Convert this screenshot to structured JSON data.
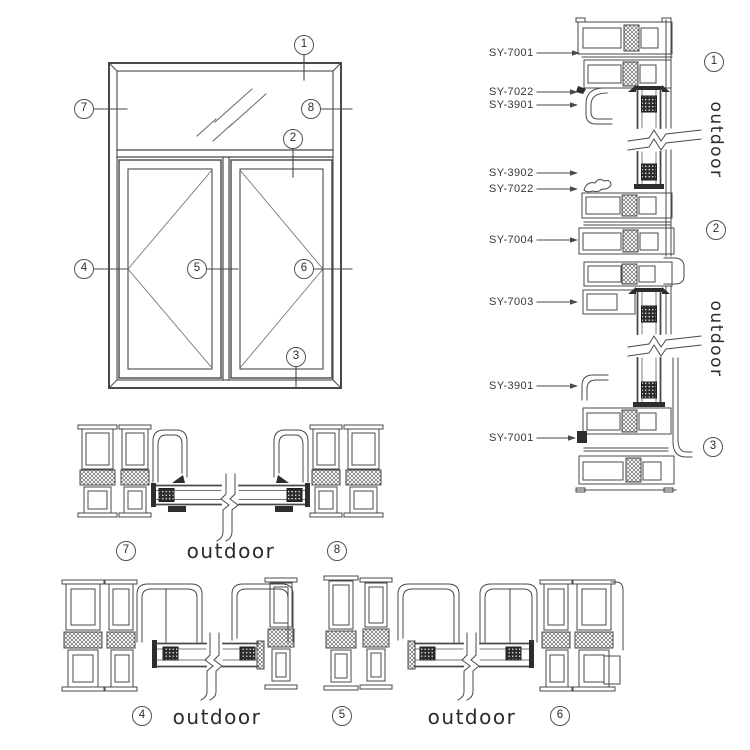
{
  "palette": {
    "background": "#ffffff",
    "line": "#4b4846",
    "dark_fill": "#2e2d2b",
    "text": "#33312f"
  },
  "elevation": {
    "callouts": [
      {
        "n": "1"
      },
      {
        "n": "2"
      },
      {
        "n": "3"
      },
      {
        "n": "4"
      },
      {
        "n": "5"
      },
      {
        "n": "6"
      },
      {
        "n": "7"
      },
      {
        "n": "8"
      }
    ]
  },
  "right_section": {
    "labels": [
      {
        "text": "SY-7001"
      },
      {
        "text": "SY-7022"
      },
      {
        "text": "SY-3901"
      },
      {
        "text": "SY-3902"
      },
      {
        "text": "SY-7022"
      },
      {
        "text": "SY-7004"
      },
      {
        "text": "SY-7003"
      },
      {
        "text": "SY-3901"
      },
      {
        "text": "SY-7001"
      }
    ],
    "detail_markers": [
      {
        "n": "1"
      },
      {
        "n": "2"
      },
      {
        "n": "3"
      }
    ],
    "outdoor_labels": [
      {
        "text": "outdoor"
      },
      {
        "text": "outdoor"
      }
    ]
  },
  "middle_section": {
    "markers": [
      {
        "n": "7"
      },
      {
        "n": "8"
      }
    ],
    "outdoor_label": "outdoor"
  },
  "bottom_section": {
    "markers": [
      {
        "n": "4"
      },
      {
        "n": "5"
      },
      {
        "n": "6"
      }
    ],
    "outdoor_labels": [
      {
        "text": "outdoor"
      },
      {
        "text": "outdoor"
      }
    ]
  }
}
